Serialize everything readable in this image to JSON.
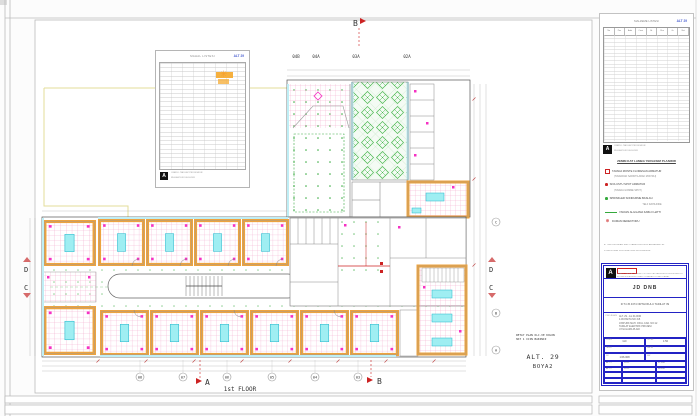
{
  "page": {
    "floor_label": "1st FLOOR",
    "alt_code": "ALT. 29",
    "alt_sub": "BOYA2",
    "plan_note_1": "DETAY PLAN OLC.VE KOLON",
    "plan_note_2": "HAT 1 ICIN BAKINIZ"
  },
  "markers": {
    "section_top_b": "B",
    "section_bottom_a": "A",
    "section_bottom_b": "B",
    "left_d": "D",
    "left_c": "C",
    "right_d": "D",
    "right_c": "C"
  },
  "grid": {
    "top": [
      "04B",
      "04A",
      "03A",
      "02A"
    ],
    "bottom": [
      "08",
      "07",
      "06",
      "05",
      "04",
      "03"
    ],
    "right": [
      "C",
      "B",
      "A"
    ]
  },
  "legend_table": {
    "title": "MAHAL LISTESI",
    "code": "ALT 29"
  },
  "panel": {
    "schedule": {
      "title": "MALZEME LISTESI",
      "code": "ALT 29",
      "headers": [
        "No",
        "Poz",
        "Adet",
        "Cinsi",
        "Br",
        "Olcu",
        "Gr",
        "Not"
      ]
    },
    "stamp_letter": "A",
    "stamp_text_1": "ONAYLI: TADILAT PROJESIDIR",
    "stamp_text_2": "RUHSAT EKI DEGILDIR",
    "legend": {
      "heading": "ZEMIN KAT LAMBA YERLESIM PLANIDIR",
      "items": [
        {
          "icon": "red-square",
          "text": "TAVANA MONTE FLORESAN ARMATUR",
          "sub": "(TAVANDAN SARKITILARAK MONTAJ)"
        },
        {
          "icon": "red-dot",
          "text": "SIVA USTU SPOT ARMATUR",
          "sub": "(TAVANA GOMME SPOT)"
        },
        {
          "icon": "green-dot",
          "text": "SPRINKLER SONDURME BASLIGI",
          "sub": "TELF DAHILINDE"
        },
        {
          "icon": "green-line",
          "text": "YANGIN ALGILAMA KABLO HATTI"
        },
        {
          "icon": "red-target",
          "text": "DUMAN DEDEKTORU"
        }
      ]
    },
    "notes": [
      "a. TUM OLCULER SANTIYEDE KONTROL EDILECEKTIR.",
      "b. DETAYLAR ICIN ILGILI PAFTAYA BAKINIZ."
    ],
    "title_block": {
      "logo_letter": "A",
      "header_line_1": "ONAYLI: TADILAT TESISAT PROJESI KAPSAMINDA DUZENLENMISTIR",
      "header_line_2": "BU PAFTA IDARENIN ONAYI OLMADAN COGALTILAMAZ",
      "company": "JD DNB",
      "project": "R.T.C.B 4374 ORTAOKULU TADILAT ISI",
      "section_label": "PROJE ADI",
      "address_lines": [
        "ALT. 29 - 1st FLOOR",
        "4.06 PAFTA NO 3-B",
        "ATATURK MAH. OKUL CAD. NO:12",
        "TADILAT ELEKTRIK PROJESI",
        "UYGULAMA PLANI"
      ],
      "cells": [
        {
          "label": "CIZEN",
          "value": "GD"
        },
        {
          "label": "OLCEK",
          "value": "1:50"
        },
        {
          "label": "TARIH",
          "value": ""
        },
        {
          "label": "PAFTA",
          "value": ""
        },
        {
          "label": "NO",
          "value": "1:06.008"
        },
        {
          "label": "KAT",
          "value": ""
        }
      ],
      "rev_rows": [
        [
          "ALT 1",
          "09.21",
          "07.008"
        ],
        [
          "ALT 2",
          "09.21",
          "08.008"
        ]
      ]
    }
  },
  "colors": {
    "wall_orange": "#eda33f",
    "ceiling_grid_pink": "#f2a8cc",
    "fixture_cyan": "#9feef2",
    "sprinkler_green": "#35a93c",
    "section_red": "#cc2222",
    "code_blue": "#4a5fd0",
    "titleblock_blue": "#2323c4"
  }
}
